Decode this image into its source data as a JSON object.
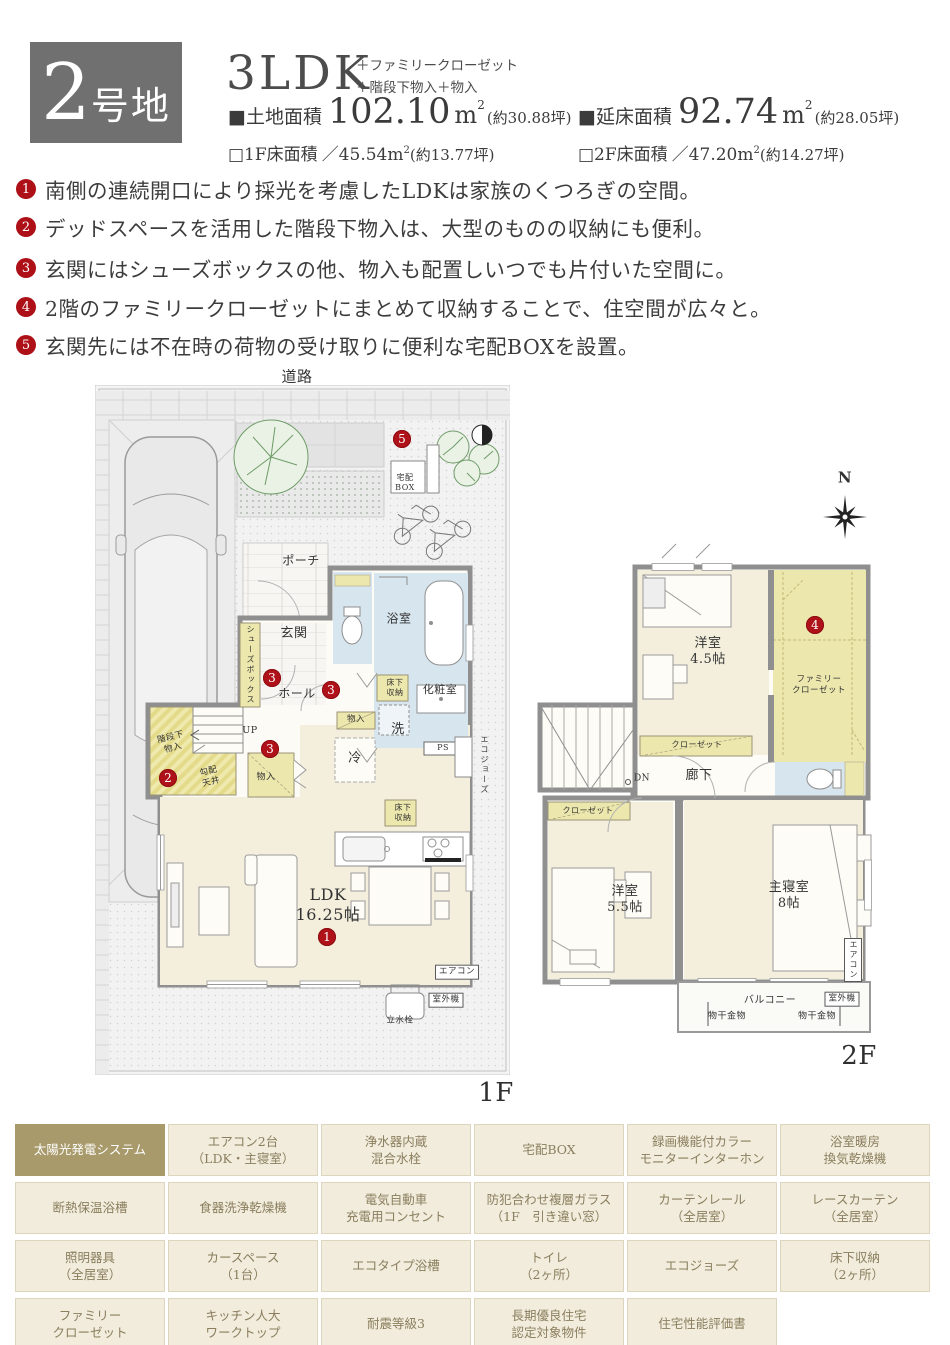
{
  "colors": {
    "accent_red": "#b0121a",
    "lot_box_gray": "#707070",
    "feature_highlight": "#a89a6b",
    "room_cream": "#f3efdc",
    "closet_yellow": "#ece7ad",
    "wet_blue": "#d7e5ee",
    "wall_gray": "#8f8f8f"
  },
  "header": {
    "lot_number": "2",
    "lot_suffix": "号地",
    "plan_type": "3LDK",
    "plan_extra_1": "＋ファミリークローゼット",
    "plan_extra_2": "＋階段下物入＋物入",
    "land_label": "■土地面積",
    "land_value": "102.10",
    "land_unit": "m",
    "land_sup": "2",
    "land_tsubo": "(約30.88坪)",
    "total_label": "■延床面積",
    "total_value": "92.74",
    "total_unit": "m",
    "total_sup": "2",
    "total_tsubo": "(約28.05坪)",
    "f1_label": "□1F床面積",
    "f1_value": "／45.54",
    "f1_unit": "m",
    "f1_sup": "2",
    "f1_tsubo": "(約13.77坪)",
    "f2_label": "□2F床面積",
    "f2_value": "／47.20",
    "f2_unit": "m",
    "f2_sup": "2",
    "f2_tsubo": "(約14.27坪)"
  },
  "bullets": [
    {
      "num": "1",
      "text": "南側の連続開口により採光を考慮したLDKは家族のくつろぎの空間。"
    },
    {
      "num": "2",
      "text": "デッドスペースを活用した階段下物入は、大型のものの収納にも便利。"
    },
    {
      "num": "3",
      "text": "玄関にはシューズボックスの他、物入も配置しいつでも片付いた空間に。"
    },
    {
      "num": "4",
      "text": "2階のファミリークローゼットにまとめて収納することで、住空間が広々と。"
    },
    {
      "num": "5",
      "text": "玄関先には不在時の荷物の受け取りに便利な宅配BOXを設置。"
    }
  ],
  "markers": {
    "m1": "1",
    "m2": "2",
    "m3": "3",
    "m4": "4",
    "m5": "5"
  },
  "plan1f": {
    "road": "道路",
    "porch": "ポーチ",
    "entrance": "玄関",
    "shoes_box": "シューズボックス",
    "bath": "浴室",
    "hall": "ホール",
    "underfloor1": "床下\n収納",
    "powder": "化粧室",
    "storage1": "物入",
    "wash": "洗",
    "fridge": "冷",
    "ps": "PS",
    "ecojozu": "エコジョーズ",
    "up": "UP",
    "under_stairs": "階段下\n物入",
    "sloped": "勾配\n天井",
    "storage2": "物入",
    "underfloor2": "床下\n収納",
    "ldk": "LDK\n16.25帖",
    "aircon": "エアコン",
    "outdoor_unit": "室外機",
    "faucet": "立水栓",
    "delivery_box": "宅配\nBOX",
    "floor_label": "1F"
  },
  "plan2f": {
    "north": "N",
    "room45": "洋室\n4.5帖",
    "family_closet": "ファミリー\nクローゼット",
    "closet1": "クローゼット",
    "corridor": "廊下",
    "dn": "DN",
    "closet2": "クローゼット",
    "room55": "洋室\n5.5帖",
    "master": "主寝室\n8帖",
    "aircon": "エアコン",
    "balcony": "バルコニー",
    "outdoor_unit": "室外機",
    "hanger1": "物干金物",
    "hanger2": "物干金物",
    "floor_label": "2F"
  },
  "features": {
    "c0": "太陽光発電システム",
    "c1": "エアコン2台\n（LDK・主寝室）",
    "c2": "浄水器内蔵\n混合水栓",
    "c3": "宅配BOX",
    "c4": "録画機能付カラー\nモニターインターホン",
    "c5": "浴室暖房\n換気乾燥機",
    "c6": "断熱保温浴槽",
    "c7": "食器洗浄乾燥機",
    "c8": "電気自動車\n充電用コンセント",
    "c9": "防犯合わせ複層ガラス\n（1F　引き違い窓）",
    "c10": "カーテンレール\n（全居室）",
    "c11": "レースカーテン\n（全居室）",
    "c12": "照明器具\n（全居室）",
    "c13": "カースペース\n（1台）",
    "c14": "エコタイプ浴槽",
    "c15": "トイレ\n（2ヶ所）",
    "c16": "エコジョーズ",
    "c17": "床下収納\n（2ヶ所）",
    "c18": "ファミリー\nクローゼット",
    "c19": "キッチン人大\nワークトップ",
    "c20": "耐震等級3",
    "c21": "長期優良住宅\n認定対象物件",
    "c22": "住宅性能評価書"
  }
}
